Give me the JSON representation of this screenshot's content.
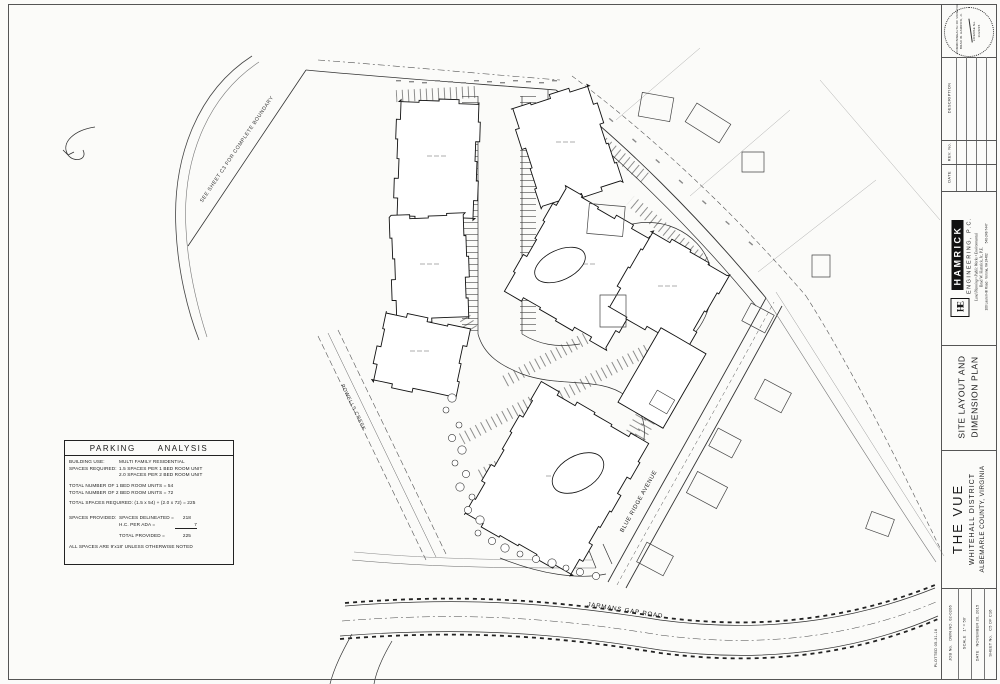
{
  "plan": {
    "boundary_note": "SEE SHEET C3 FOR COMPLETE BOUNDARY",
    "creek_label": "POWELLS CREEK",
    "avenue_label": "BLUE RIDGE AVENUE",
    "road_label": "JARMANS GAP ROAD"
  },
  "parking": {
    "title_word1": "PARKING",
    "title_word2": "ANALYSIS",
    "building_use_label": "BUILDING USE:",
    "building_use_value": "MULTI FAMILY RESIDENTIAL",
    "required_label": "SPACES REQUIRED:",
    "required_line1": "1.5 SPACES PER 1 BED ROOM UNIT",
    "required_line2": "2.0 SPACES PER 2 BED ROOM UNIT",
    "total_1br": "TOTAL NUMBER OF 1 BED ROOM UNITS = 54",
    "total_2br": "TOTAL NUMBER OF 2 BED ROOM UNITS = 72",
    "total_required": "TOTAL SPACES REQUIRED:  (1.5 x 54) + (2.0 x 72) = 225",
    "provided_label": "SPACES PROVIDED:",
    "delineated_label": "SPACES DELINEATED =",
    "delineated_value": "218",
    "hc_label": "H.C. PER ADA =",
    "hc_value": "7",
    "total_provided_label": "TOTAL PROVIDED =",
    "total_provided_value": "225",
    "note": "ALL SPACES ARE 9'x18' UNLESS OTHERWISE NOTED"
  },
  "titleblock": {
    "seal": {
      "authority": "COMMONWEALTH OF VIRGINIA",
      "name": "BRAD W. HAMRICK, Jr.",
      "license": "LICENSE No.",
      "date": "11/20/15"
    },
    "revisions": {
      "date_label": "DATE",
      "rev_label": "REV. No.",
      "description_label": "DESCRIPTION"
    },
    "firm": {
      "logo": "HE",
      "name": "HAMRICK",
      "type": "ENGINEERING, P.C.",
      "tagline": "Land Planning • Public Works • Environmental",
      "principal": "Brad W. Hamrick, Jr., P.E.",
      "address": "100 Laurel Hill Road · Verona, VA 24482",
      "phone": "540-248-7447"
    },
    "sheet_title_line1": "SITE LAYOUT AND",
    "sheet_title_line2": "DIMENSION PLAN",
    "project_name": "THE VUE",
    "project_district": "WHITEHALL DISTRICT",
    "project_location": "ALBEMARLE COUNTY, VIRGINIA",
    "job_label": "JOB No.",
    "job_value": "DWN NO. 02-0206",
    "scale_label": "SCALE",
    "scale_value": "1\" = 50'",
    "date_label": "DATE",
    "date_value": "NOVEMBER 20, 2015",
    "sheet_label": "SHEET No.",
    "sheet_value": "C5 OF C16",
    "plotted": "PLOTTED 05-31-16"
  }
}
